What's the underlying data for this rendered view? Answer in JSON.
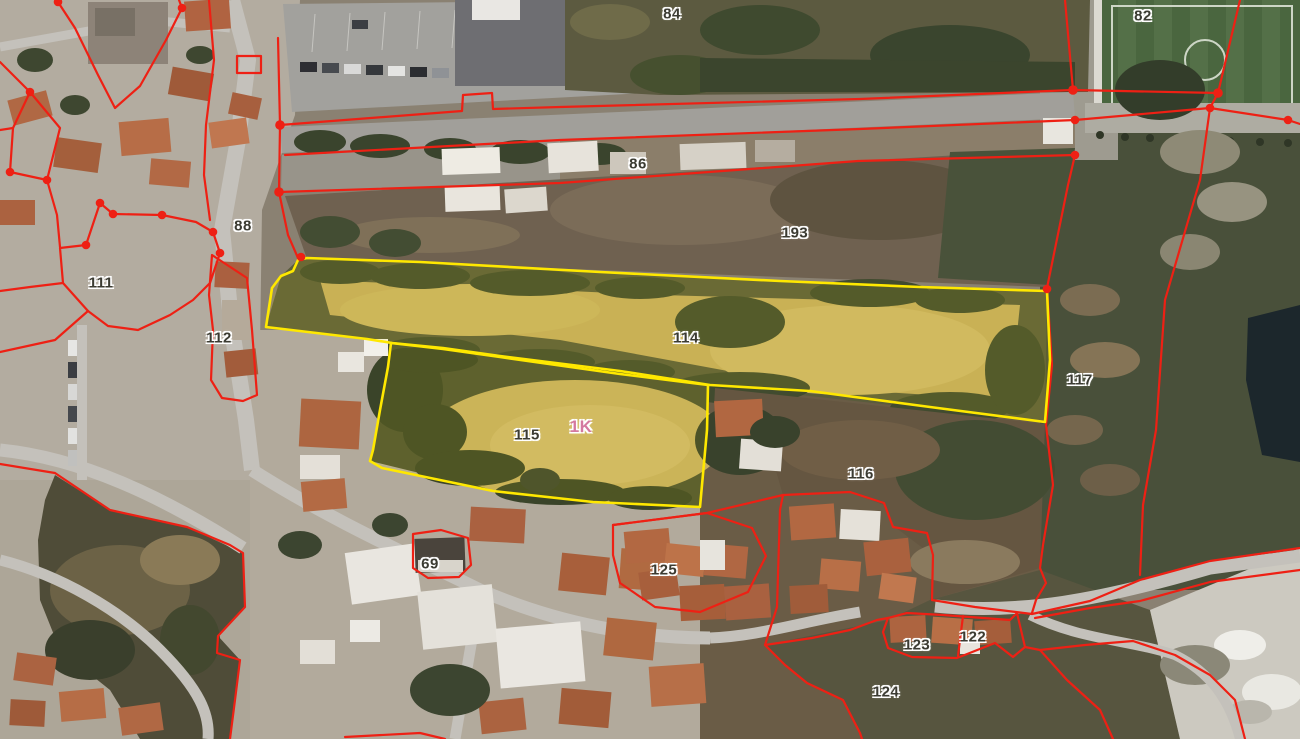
{
  "map": {
    "type": "aerial-cadastral-view",
    "description": "Satellite imagery with cadastral parcel boundaries; two parcels highlighted in yellow",
    "selected_parcel_tag": "1K",
    "colors": {
      "boundary_red": "#ee2014",
      "boundary_yellow": "#ffe800",
      "label_dark": "#3b3b32",
      "label_pink": "#d4799f",
      "label_halo": "#ffffff"
    },
    "parcels": [
      {
        "label": "84",
        "x": 672,
        "y": 14,
        "style": "dark"
      },
      {
        "label": "82",
        "x": 1143,
        "y": 16,
        "style": "dark"
      },
      {
        "label": "86",
        "x": 638,
        "y": 164,
        "style": "dark"
      },
      {
        "label": "88",
        "x": 243,
        "y": 226,
        "style": "dark"
      },
      {
        "label": "193",
        "x": 795,
        "y": 233,
        "style": "dark"
      },
      {
        "label": "111",
        "x": 101,
        "y": 283,
        "style": "dark"
      },
      {
        "label": "112",
        "x": 219,
        "y": 338,
        "style": "dark"
      },
      {
        "label": "114",
        "x": 686,
        "y": 338,
        "style": "dark"
      },
      {
        "label": "115",
        "x": 527,
        "y": 435,
        "style": "dark"
      },
      {
        "label": "1K",
        "x": 581,
        "y": 427,
        "style": "pink"
      },
      {
        "label": "117",
        "x": 1080,
        "y": 380,
        "style": "dark"
      },
      {
        "label": "116",
        "x": 861,
        "y": 474,
        "style": "dark"
      },
      {
        "label": "69",
        "x": 430,
        "y": 564,
        "style": "dark"
      },
      {
        "label": "125",
        "x": 664,
        "y": 570,
        "style": "dark"
      },
      {
        "label": "123",
        "x": 917,
        "y": 645,
        "style": "dark"
      },
      {
        "label": "122",
        "x": 973,
        "y": 637,
        "style": "dark"
      },
      {
        "label": "124",
        "x": 886,
        "y": 692,
        "style": "dark"
      }
    ]
  }
}
